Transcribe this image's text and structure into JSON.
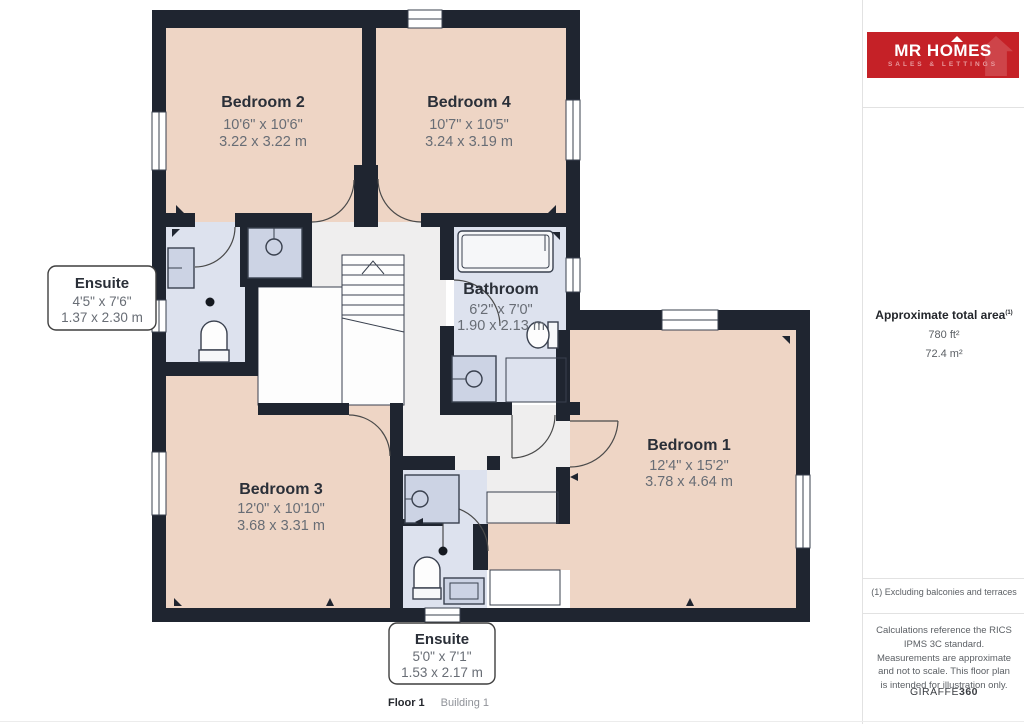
{
  "plan": {
    "rooms": [
      {
        "id": "bedroom-2",
        "name": "Bedroom 2",
        "imperial": "10'6\" x 10'6\"",
        "metric": "3.22 x 3.22 m"
      },
      {
        "id": "bedroom-4",
        "name": "Bedroom 4",
        "imperial": "10'7\" x 10'5\"",
        "metric": "3.24 x 3.19 m"
      },
      {
        "id": "ensuite-top",
        "name": "Ensuite",
        "imperial": "4'5\" x 7'6\"",
        "metric": "1.37 x 2.30 m"
      },
      {
        "id": "bathroom",
        "name": "Bathroom",
        "imperial": "6'2\" x 7'0\"",
        "metric": "1.90 x 2.13 m"
      },
      {
        "id": "bedroom-1",
        "name": "Bedroom 1",
        "imperial": "12'4\" x 15'2\"",
        "metric": "3.78 x 4.64 m"
      },
      {
        "id": "bedroom-3",
        "name": "Bedroom 3",
        "imperial": "12'0\" x 10'10\"",
        "metric": "3.68 x 3.31 m"
      },
      {
        "id": "ensuite-bottom",
        "name": "Ensuite",
        "imperial": "5'0\" x 7'1\"",
        "metric": "1.53 x 2.17 m"
      }
    ],
    "footer": {
      "floor": "Floor 1",
      "building": "Building 1"
    }
  },
  "sidebar": {
    "logo": {
      "brand": "MR HOMES",
      "tagline": "SALES & LETTINGS"
    },
    "area": {
      "title": "Approximate total area",
      "superscript": "(1)",
      "imperial": "780 ft²",
      "metric": "72.4 m²"
    },
    "note": "(1) Excluding balconies and terraces",
    "disclaimer": "Calculations reference the RICS IPMS 3C standard. Measurements are approximate and not to scale. This floor plan is intended for illustration only.",
    "credit": {
      "brand": "GIRAFFE",
      "suffix": "360"
    }
  },
  "colors": {
    "wall": "#1f2530",
    "bedroom_fill": "#eed5c5",
    "bath_fill": "#dde2ee",
    "hall_fill": "#efeeee",
    "closet_fill": "#d8d5d1",
    "logo_red": "#c52127",
    "logo_tagline": "#e89a9e"
  }
}
